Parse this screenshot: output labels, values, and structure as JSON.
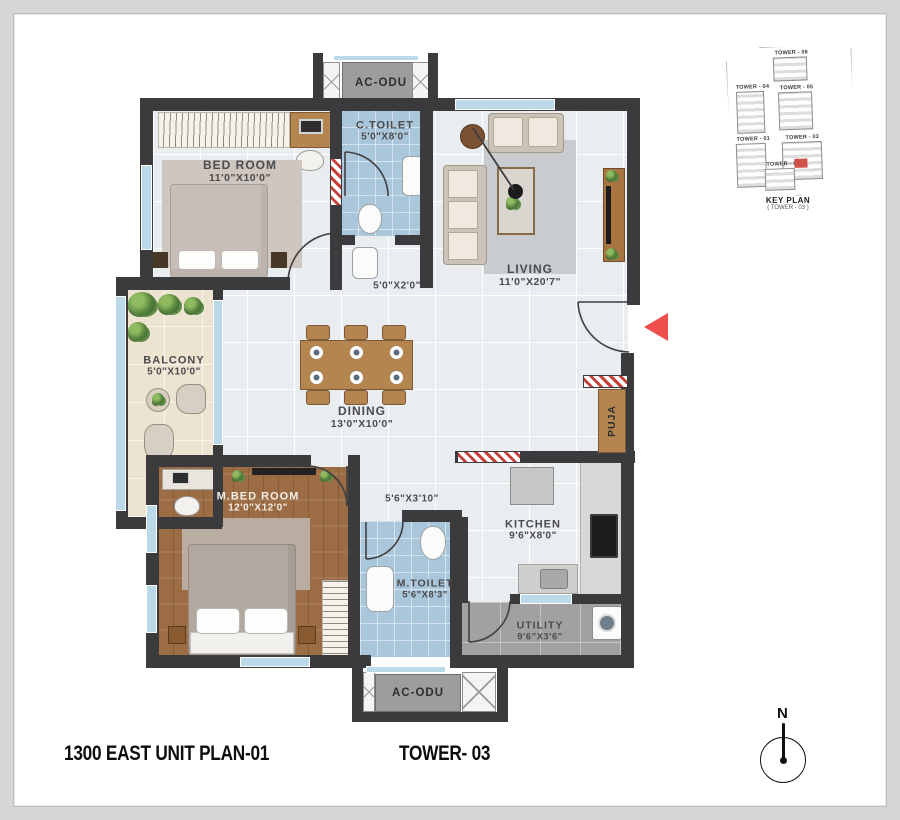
{
  "meta": {
    "plan_title": "1300 EAST UNIT PLAN-01",
    "tower_title": "TOWER- 03"
  },
  "compass": {
    "label": "N"
  },
  "ac_units": {
    "top": "AC-ODU",
    "bottom": "AC-ODU"
  },
  "rooms": {
    "bedroom": {
      "name": "BED ROOM",
      "dim": "11'0\"X10'0\""
    },
    "c_toilet": {
      "name": "C.TOILET",
      "dim": "5'0\"X8'0\""
    },
    "wash_area": {
      "dim": "5'0\"X2'0\""
    },
    "living": {
      "name": "LIVING",
      "dim": "11'0\"X20'7\""
    },
    "balcony": {
      "name": "BALCONY",
      "dim": "5'0\"X10'0\""
    },
    "dining": {
      "name": "DINING",
      "dim": "13'0\"X10'0\""
    },
    "master_bedroom": {
      "name": "M.BED ROOM",
      "dim": "12'0\"X12'0\""
    },
    "passage": {
      "dim": "5'6\"X3'10\""
    },
    "m_toilet": {
      "name": "M.TOILET",
      "dim": "5'6\"X8'3\""
    },
    "kitchen": {
      "name": "KITCHEN",
      "dim": "9'6\"X8'0\""
    },
    "utility": {
      "name": "UTILITY",
      "dim": "9'6\"X3'6\""
    },
    "puja": {
      "name": "PUJA"
    }
  },
  "key_plan": {
    "caption": "KEY PLAN",
    "subcaption": "( TOWER - 03 )",
    "towers": [
      "TOWER - 06",
      "TOWER - 04",
      "TOWER - 05",
      "TOWER - 01",
      "TOWER - 03",
      "TOWER - 02"
    ],
    "highlighted_tower": "TOWER - 03"
  },
  "colors": {
    "wall": "#3b3b3d",
    "entry_arrow_red": "#ee4f4a",
    "toilet_tile_blue": "#a9c6da",
    "wood_floor": "#9c6c44",
    "balcony_floor": "#ece3d1",
    "window_blue": "#bcd9ea",
    "keyplan_highlight": "#d05248"
  }
}
